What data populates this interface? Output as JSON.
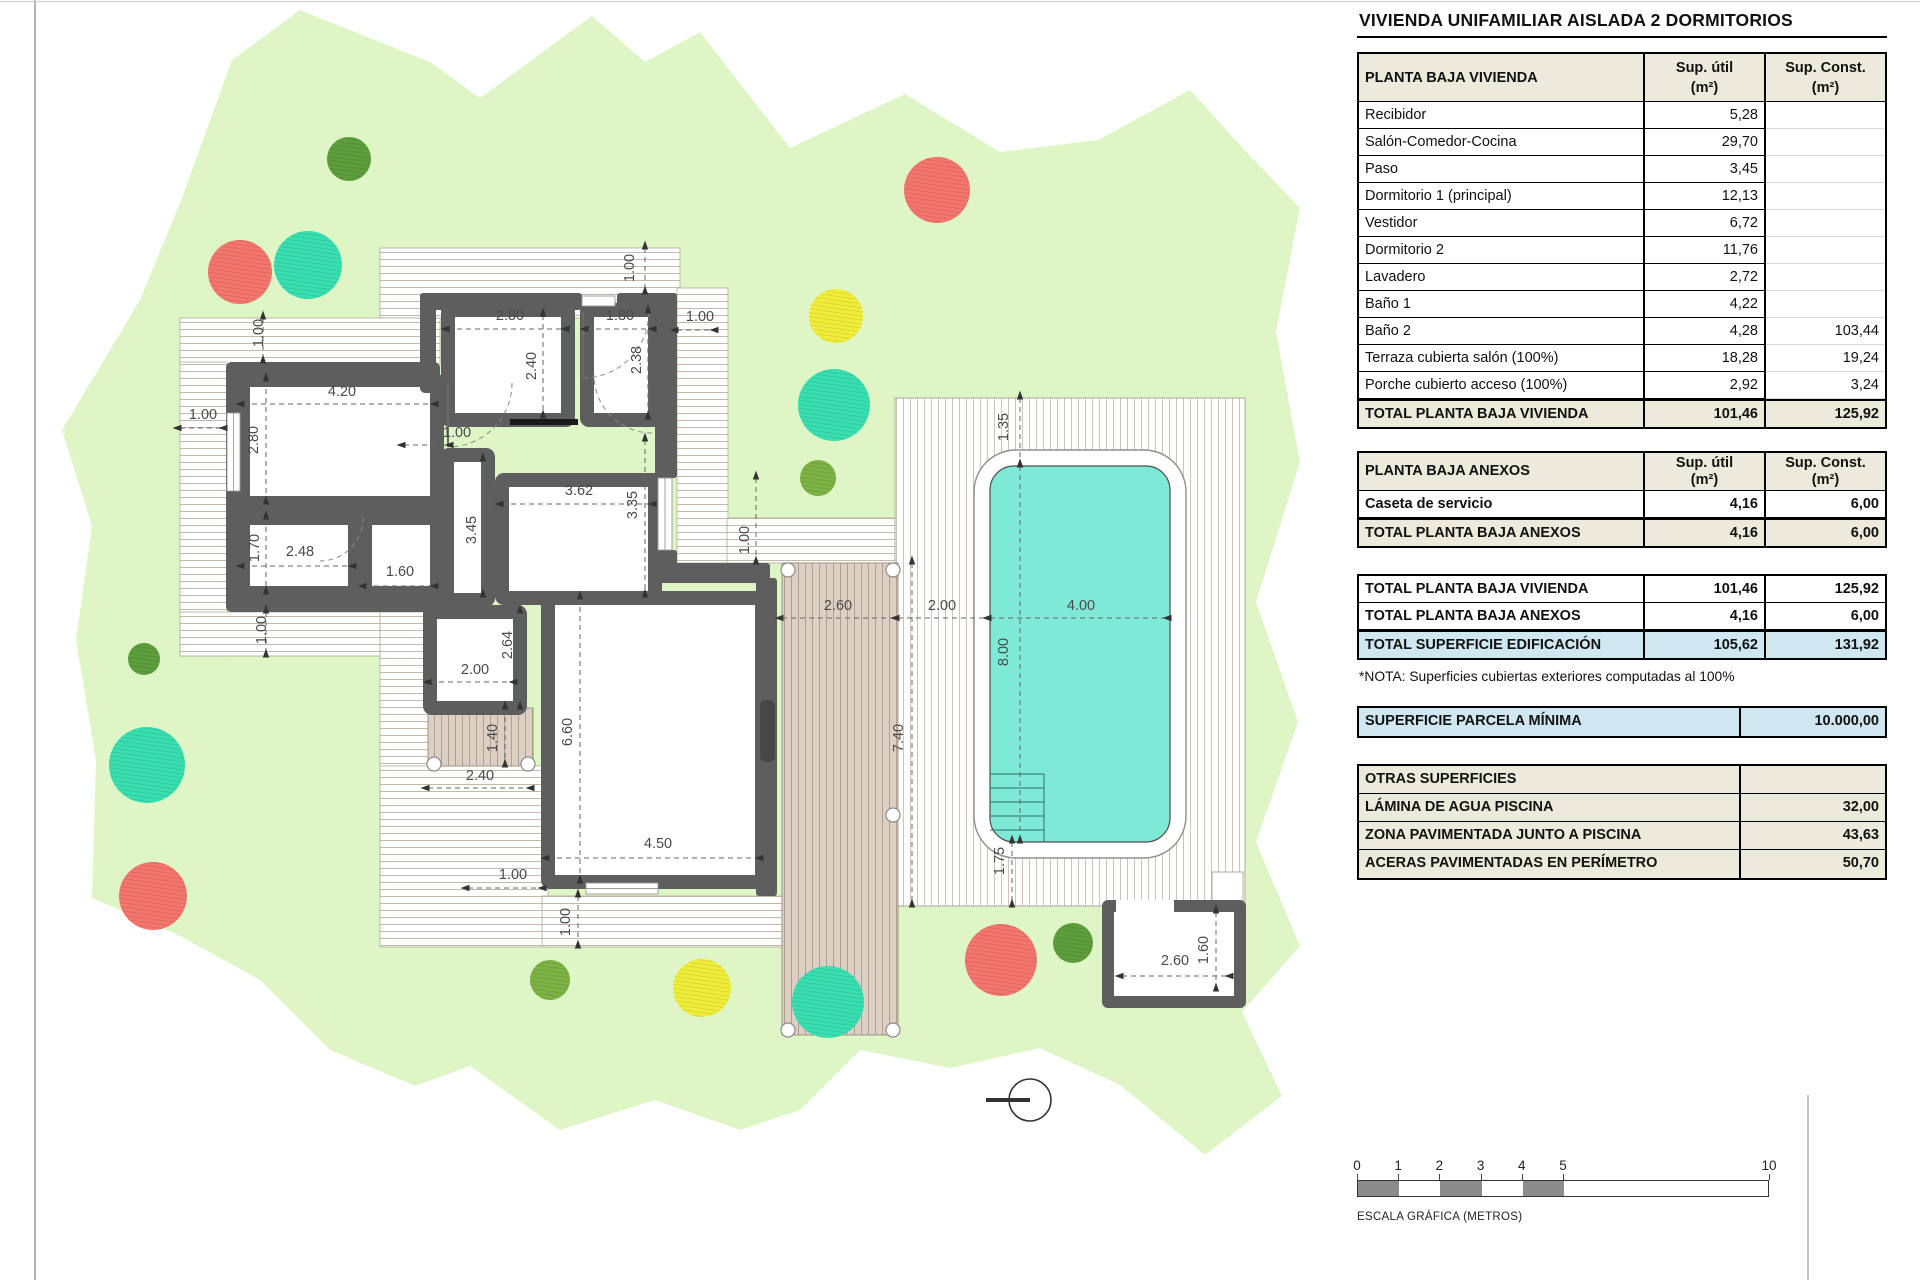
{
  "title": "VIVIENDA UNIFAMILIAR AISLADA 2 DORMITORIOS",
  "tables": {
    "vivienda": {
      "header": [
        "PLANTA BAJA VIVIENDA",
        "Sup. útil\n(m²)",
        "Sup. Const.\n(m²)"
      ],
      "rows": [
        [
          "Recibidor",
          "5,28",
          ""
        ],
        [
          "Salón-Comedor-Cocina",
          "29,70",
          ""
        ],
        [
          "Paso",
          "3,45",
          ""
        ],
        [
          "Dormitorio 1 (principal)",
          "12,13",
          ""
        ],
        [
          "Vestidor",
          "6,72",
          ""
        ],
        [
          "Dormitorio 2",
          "11,76",
          ""
        ],
        [
          "Lavadero",
          "2,72",
          ""
        ],
        [
          "Baño 1",
          "4,22",
          ""
        ],
        [
          "Baño 2",
          "4,28",
          "103,44"
        ],
        [
          "Terraza cubierta salón (100%)",
          "18,28",
          "19,24"
        ],
        [
          "Porche cubierto acceso (100%)",
          "2,92",
          "3,24"
        ]
      ],
      "total": [
        "TOTAL PLANTA BAJA VIVIENDA",
        "101,46",
        "125,92"
      ]
    },
    "anexos": {
      "header": [
        "PLANTA BAJA ANEXOS",
        "Sup. útil\n(m²)",
        "Sup. Const.\n(m²)"
      ],
      "rows": [
        [
          "Caseta de servicio",
          "4,16",
          "6,00"
        ]
      ],
      "total": [
        "TOTAL PLANTA BAJA ANEXOS",
        "4,16",
        "6,00"
      ]
    },
    "resumen": {
      "rows": [
        [
          "TOTAL PLANTA BAJA VIVIENDA",
          "101,46",
          "125,92"
        ],
        [
          "TOTAL PLANTA BAJA ANEXOS",
          "4,16",
          "6,00"
        ]
      ],
      "total": [
        "TOTAL SUPERFICIE EDIFICACIÓN",
        "105,62",
        "131,92"
      ]
    },
    "nota": "*NOTA: Superficies cubiertas exteriores computadas al 100%",
    "parcela": {
      "label": "SUPERFICIE PARCELA MÍNIMA",
      "value": "10.000,00"
    },
    "otras": {
      "header": "OTRAS SUPERFICIES",
      "rows": [
        [
          "LÁMINA DE AGUA PISCINA",
          "32,00"
        ],
        [
          "ZONA PAVIMENTADA JUNTO A PISCINA",
          "43,63"
        ],
        [
          "ACERAS PAVIMENTADAS EN PERÍMETRO",
          "50,70"
        ]
      ]
    }
  },
  "scale_bar": {
    "ticks": [
      "0",
      "1",
      "2",
      "3",
      "4",
      "5",
      "10"
    ],
    "positions": [
      0,
      41.2,
      82.4,
      123.6,
      164.8,
      206,
      412
    ],
    "label": "ESCALA GRÁFICA (METROS)"
  },
  "colors": {
    "garden": "#def5c5",
    "deck_line": "#c3b9a8",
    "paving_line": "#ccc4b6",
    "terrace_bg": "#dcd0c5",
    "terrace_line": "#b29d8e",
    "wall": "#5e5e5e",
    "pool_water": "#7de9d6",
    "table_header_bg": "#eceadb",
    "highlight_bg": "#cfe7f0",
    "scale_gray": "#8c8c8c"
  },
  "plan": {
    "dimensions": [
      {
        "t": "1.00",
        "x": 263,
        "y": 333,
        "o": "v"
      },
      {
        "t": "1.00",
        "x": 634,
        "y": 268,
        "o": "v"
      },
      {
        "t": "2.80",
        "x": 510,
        "y": 320,
        "o": "h"
      },
      {
        "t": "1.80",
        "x": 620,
        "y": 320,
        "o": "h"
      },
      {
        "t": "1.00",
        "x": 700,
        "y": 321,
        "o": "h"
      },
      {
        "t": "2.40",
        "x": 536,
        "y": 366,
        "o": "v"
      },
      {
        "t": "2.38",
        "x": 641,
        "y": 360,
        "o": "v"
      },
      {
        "t": "1.00",
        "x": 203,
        "y": 419,
        "o": "h"
      },
      {
        "t": "4.20",
        "x": 342,
        "y": 396,
        "o": "h"
      },
      {
        "t": "2.80",
        "x": 258,
        "y": 440,
        "o": "v"
      },
      {
        "t": "1.00",
        "x": 457,
        "y": 437,
        "o": "h"
      },
      {
        "t": "3.62",
        "x": 579,
        "y": 495,
        "o": "h"
      },
      {
        "t": "3.45",
        "x": 476,
        "y": 530,
        "o": "v"
      },
      {
        "t": "3.35",
        "x": 637,
        "y": 505,
        "o": "v"
      },
      {
        "t": "1.70",
        "x": 259,
        "y": 548,
        "o": "v"
      },
      {
        "t": "2.48",
        "x": 300,
        "y": 556,
        "o": "h"
      },
      {
        "t": "1.60",
        "x": 400,
        "y": 576,
        "o": "h"
      },
      {
        "t": "2.00",
        "x": 475,
        "y": 674,
        "o": "h"
      },
      {
        "t": "2.64",
        "x": 512,
        "y": 645,
        "o": "v"
      },
      {
        "t": "1.00",
        "x": 266,
        "y": 630,
        "o": "v"
      },
      {
        "t": "1.40",
        "x": 497,
        "y": 738,
        "o": "v"
      },
      {
        "t": "2.40",
        "x": 480,
        "y": 780,
        "o": "h"
      },
      {
        "t": "6.60",
        "x": 572,
        "y": 732,
        "o": "v"
      },
      {
        "t": "4.50",
        "x": 658,
        "y": 848,
        "o": "h"
      },
      {
        "t": "1.00",
        "x": 513,
        "y": 879,
        "o": "h"
      },
      {
        "t": "1.00",
        "x": 570,
        "y": 922,
        "o": "v"
      },
      {
        "t": "1.00",
        "x": 749,
        "y": 540,
        "o": "v"
      },
      {
        "t": "2.60",
        "x": 838,
        "y": 610,
        "o": "h"
      },
      {
        "t": "2.00",
        "x": 942,
        "y": 610,
        "o": "h"
      },
      {
        "t": "4.00",
        "x": 1081,
        "y": 610,
        "o": "h"
      },
      {
        "t": "1.35",
        "x": 1008,
        "y": 427,
        "o": "v"
      },
      {
        "t": "8.00",
        "x": 1008,
        "y": 652,
        "o": "v"
      },
      {
        "t": "7.40",
        "x": 903,
        "y": 738,
        "o": "v"
      },
      {
        "t": "1.75",
        "x": 1004,
        "y": 861,
        "o": "v"
      },
      {
        "t": "2.60",
        "x": 1175,
        "y": 965,
        "o": "h"
      },
      {
        "t": "1.60",
        "x": 1208,
        "y": 950,
        "o": "v"
      }
    ],
    "trees": [
      {
        "c": "#5f9e3c",
        "x": 349,
        "y": 159,
        "r": 22
      },
      {
        "c": "#38dfb0",
        "x": 308,
        "y": 265,
        "r": 34
      },
      {
        "c": "#f4766d",
        "x": 240,
        "y": 272,
        "r": 32
      },
      {
        "c": "#f4766d",
        "x": 937,
        "y": 190,
        "r": 33
      },
      {
        "c": "#f1ee39",
        "x": 836,
        "y": 316,
        "r": 27
      },
      {
        "c": "#38dfb0",
        "x": 834,
        "y": 405,
        "r": 36
      },
      {
        "c": "#7cb344",
        "x": 818,
        "y": 478,
        "r": 18
      },
      {
        "c": "#5f9e3c",
        "x": 144,
        "y": 659,
        "r": 16
      },
      {
        "c": "#38dfb0",
        "x": 147,
        "y": 765,
        "r": 38
      },
      {
        "c": "#f4766d",
        "x": 153,
        "y": 896,
        "r": 34
      },
      {
        "c": "#7cb344",
        "x": 550,
        "y": 980,
        "r": 20
      },
      {
        "c": "#f1ee39",
        "x": 702,
        "y": 988,
        "r": 29
      },
      {
        "c": "#38dfb0",
        "x": 828,
        "y": 1002,
        "r": 36
      },
      {
        "c": "#f4766d",
        "x": 1001,
        "y": 960,
        "r": 36
      },
      {
        "c": "#5f9e3c",
        "x": 1073,
        "y": 943,
        "r": 20
      }
    ]
  }
}
